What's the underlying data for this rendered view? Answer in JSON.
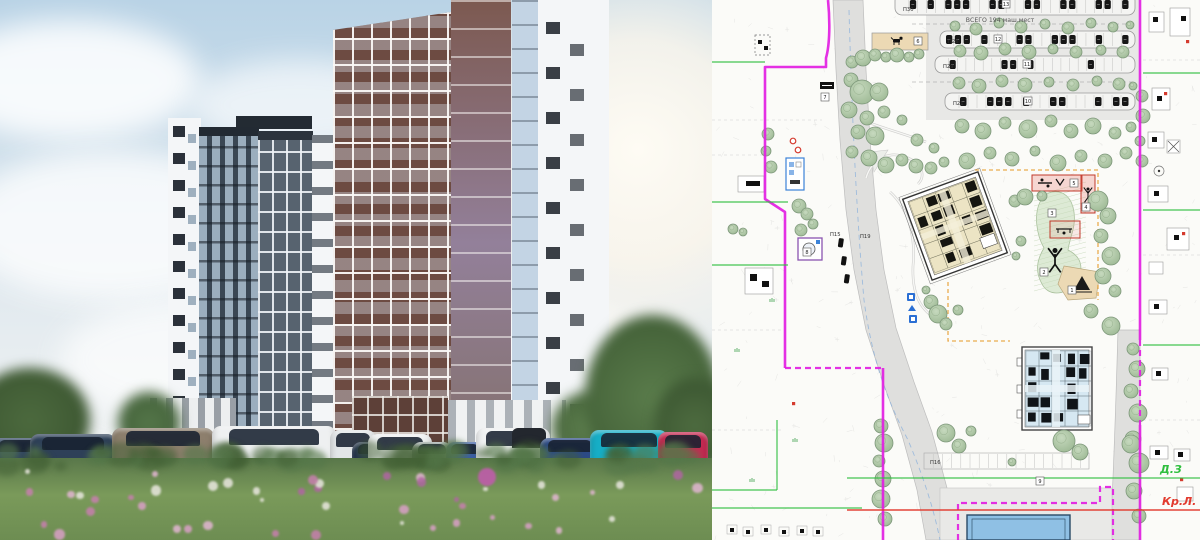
{
  "palette": {
    "sky1": "#b9d3e6",
    "sky2": "#e2eaef",
    "t_dark": "#3a4754",
    "t_mid": "#57636f",
    "t_white": "#f4f6f8",
    "t_brown": "#6d4b42",
    "t_brown2": "#7c5950",
    "meadow1": "#59774a",
    "meadow2": "#7a9a5a",
    "boundary": "#e21ee2",
    "green": "#2fbf3f",
    "red": "#e23a2e",
    "orange": "#e8a33d",
    "road": "#dfdfdd",
    "tree": "#b5cbad",
    "treeStroke": "#7d977a",
    "bld1": "#ece4c4",
    "bld2": "#d6e8f2",
    "bluebld": "#8fc0e4",
    "sand": "#ecd9b4"
  },
  "render": {
    "cars": [
      {
        "x": -8,
        "w": 52,
        "h": 34,
        "c": "#324664"
      },
      {
        "x": 30,
        "w": 86,
        "h": 38,
        "c": "#2e4058"
      },
      {
        "x": 112,
        "w": 102,
        "h": 44,
        "c": "#8d7f6d"
      },
      {
        "x": 212,
        "w": 124,
        "h": 46,
        "c": "#eef0f1"
      },
      {
        "x": 330,
        "w": 46,
        "h": 42,
        "c": "#e3e6e8"
      },
      {
        "x": 352,
        "w": 40,
        "h": 30,
        "c": "#253450"
      },
      {
        "x": 368,
        "w": 64,
        "h": 38,
        "c": "#eff1f2"
      },
      {
        "x": 412,
        "w": 40,
        "h": 30,
        "c": "#b6bcc2"
      },
      {
        "x": 446,
        "w": 38,
        "h": 30,
        "c": "#3a5da8"
      },
      {
        "x": 476,
        "w": 74,
        "h": 44,
        "c": "#f0f2f3",
        "canopy": "#23272e"
      },
      {
        "x": 540,
        "w": 60,
        "h": 34,
        "c": "#2c4a86"
      },
      {
        "x": 590,
        "w": 78,
        "h": 42,
        "c": "#17aec6"
      },
      {
        "x": 658,
        "w": 50,
        "h": 40,
        "c": "#c62a52"
      }
    ],
    "flowers": {
      "palette": [
        "#c77fae",
        "#b065a2",
        "#d9a0c6",
        "#e9e7df",
        "#e2b6d2"
      ],
      "count": 46,
      "highlight": {
        "x": 487,
        "y": 477,
        "r": 9,
        "color": "#bb5fa6"
      }
    }
  },
  "plan": {
    "labels": {
      "total": {
        "text": "ВСЕГО 194 маш.мест",
        "x": 288,
        "y": 22
      },
      "zones": [
        {
          "text": "Д.З",
          "x": 448,
          "y": 473,
          "color": "#2fbf3f"
        },
        {
          "text": "Кр.Л.",
          "x": 450,
          "y": 505,
          "color": "#e23a2e"
        }
      ],
      "rows": [
        {
          "text": "П30",
          "x": 191,
          "y": 11
        },
        {
          "text": "П26",
          "x": 236,
          "y": 43
        },
        {
          "text": "П29",
          "x": 231,
          "y": 68
        },
        {
          "text": "П21",
          "x": 241,
          "y": 105
        },
        {
          "text": "П15",
          "x": 118,
          "y": 236
        },
        {
          "text": "П19",
          "x": 148,
          "y": 238
        },
        {
          "text": "П16",
          "x": 218,
          "y": 464
        }
      ]
    },
    "chips": [
      [
        294,
        4,
        "13"
      ],
      [
        286,
        39,
        "12"
      ],
      [
        315,
        64,
        "11"
      ],
      [
        316,
        101,
        "10"
      ],
      [
        206,
        41,
        "6"
      ],
      [
        113,
        97,
        "7"
      ],
      [
        95,
        252,
        "8"
      ],
      [
        328,
        481,
        "9"
      ],
      [
        360,
        290,
        "1"
      ],
      [
        332,
        272,
        "2"
      ],
      [
        340,
        213,
        "3"
      ],
      [
        374,
        207,
        "4"
      ],
      [
        362,
        183,
        "5"
      ]
    ],
    "parking_rows": [
      {
        "x": 183,
        "y": -6,
        "w": 240,
        "h": 21,
        "slots": 26,
        "cars": [
          1,
          3,
          5,
          6,
          7,
          10,
          11,
          14,
          15,
          18,
          19,
          22,
          23,
          25
        ]
      },
      {
        "x": 228,
        "y": 31,
        "w": 195,
        "h": 17,
        "slots": 21,
        "cars": [
          0,
          1,
          2,
          4,
          8,
          9,
          12,
          13,
          14,
          17,
          20
        ]
      },
      {
        "x": 223,
        "y": 56,
        "w": 200,
        "h": 17,
        "slots": 22,
        "cars": [
          1,
          7,
          8,
          10,
          17
        ]
      },
      {
        "x": 233,
        "y": 93,
        "w": 190,
        "h": 17,
        "slots": 20,
        "cars": [
          1,
          4,
          5,
          6,
          8,
          11,
          12,
          16,
          18,
          19
        ]
      }
    ],
    "boundary": {
      "solid": [
        "M116,0 C118,20 118,44 114,58 L114,67 L53,67 L53,199 L73,212 L73,368",
        "M171,368 L171,540",
        "M428,0 L428,340",
        "M428,425 L428,540"
      ],
      "dashed": [
        "M73,368 L171,368",
        "M428,340 L428,425",
        "M246,540 L246,503 L388,503 L388,487 L401,487 L401,540"
      ]
    },
    "green_lines": [
      [
        0,
        62,
        53,
        62
      ],
      [
        0,
        202,
        76,
        202
      ],
      [
        0,
        265,
        76,
        265
      ],
      [
        65,
        420,
        65,
        490
      ],
      [
        0,
        490,
        65,
        490
      ],
      [
        0,
        508,
        150,
        508
      ],
      [
        135,
        478,
        488,
        478
      ],
      [
        431,
        73,
        488,
        73
      ],
      [
        431,
        210,
        488,
        210
      ],
      [
        431,
        345,
        488,
        345
      ]
    ],
    "red_lines": [
      [
        135,
        510,
        488,
        510
      ]
    ],
    "orange_dashed": [
      "M263,170 L386,170 L386,300",
      "M236,282 L236,341 L298,341"
    ],
    "parcel_dashed": [
      [
        0,
        120,
        110,
        120
      ],
      [
        0,
        155,
        60,
        155
      ],
      [
        0,
        330,
        70,
        330
      ],
      [
        0,
        430,
        70,
        430
      ],
      [
        431,
        60,
        488,
        60
      ],
      [
        431,
        255,
        488,
        255
      ],
      [
        431,
        420,
        488,
        420
      ]
    ],
    "trees": [
      [
        140,
        62,
        6
      ],
      [
        151,
        58,
        8
      ],
      [
        163,
        55,
        6
      ],
      [
        174,
        57,
        5
      ],
      [
        185,
        55,
        7
      ],
      [
        197,
        57,
        5
      ],
      [
        207,
        54,
        5
      ],
      [
        139,
        80,
        7
      ],
      [
        150,
        92,
        12
      ],
      [
        167,
        92,
        9
      ],
      [
        137,
        110,
        8
      ],
      [
        155,
        118,
        7
      ],
      [
        172,
        112,
        6
      ],
      [
        146,
        132,
        7
      ],
      [
        163,
        136,
        9
      ],
      [
        140,
        152,
        6
      ],
      [
        157,
        158,
        8
      ],
      [
        174,
        165,
        8
      ],
      [
        190,
        160,
        6
      ],
      [
        204,
        166,
        7
      ],
      [
        219,
        168,
        6
      ],
      [
        232,
        162,
        5
      ],
      [
        190,
        120,
        5
      ],
      [
        205,
        140,
        6
      ],
      [
        222,
        148,
        5
      ],
      [
        243,
        26,
        5
      ],
      [
        264,
        29,
        6
      ],
      [
        287,
        23,
        5
      ],
      [
        309,
        27,
        6
      ],
      [
        333,
        24,
        5
      ],
      [
        356,
        28,
        6
      ],
      [
        379,
        23,
        5
      ],
      [
        401,
        27,
        5
      ],
      [
        418,
        25,
        4
      ],
      [
        248,
        51,
        6
      ],
      [
        269,
        53,
        7
      ],
      [
        293,
        49,
        6
      ],
      [
        317,
        52,
        7
      ],
      [
        341,
        49,
        5
      ],
      [
        364,
        52,
        6
      ],
      [
        389,
        50,
        5
      ],
      [
        411,
        52,
        6
      ],
      [
        247,
        83,
        6
      ],
      [
        267,
        86,
        7
      ],
      [
        290,
        81,
        6
      ],
      [
        313,
        85,
        7
      ],
      [
        337,
        82,
        5
      ],
      [
        361,
        85,
        6
      ],
      [
        385,
        81,
        5
      ],
      [
        407,
        84,
        6
      ],
      [
        421,
        86,
        4
      ],
      [
        250,
        126,
        7
      ],
      [
        271,
        131,
        8
      ],
      [
        293,
        123,
        6
      ],
      [
        316,
        129,
        9
      ],
      [
        339,
        121,
        6
      ],
      [
        359,
        131,
        7
      ],
      [
        381,
        126,
        8
      ],
      [
        403,
        133,
        6
      ],
      [
        419,
        127,
        5
      ],
      [
        255,
        161,
        8
      ],
      [
        278,
        153,
        6
      ],
      [
        300,
        159,
        7
      ],
      [
        323,
        151,
        5
      ],
      [
        346,
        163,
        8
      ],
      [
        369,
        156,
        6
      ],
      [
        393,
        161,
        7
      ],
      [
        414,
        153,
        6
      ],
      [
        56,
        134,
        6
      ],
      [
        54,
        151,
        5
      ],
      [
        59,
        167,
        6
      ],
      [
        87,
        206,
        7
      ],
      [
        95,
        214,
        6
      ],
      [
        101,
        224,
        5
      ],
      [
        89,
        230,
        6
      ],
      [
        21,
        229,
        5
      ],
      [
        31,
        232,
        4
      ],
      [
        219,
        302,
        7
      ],
      [
        226,
        314,
        9
      ],
      [
        234,
        324,
        6
      ],
      [
        246,
        310,
        5
      ],
      [
        214,
        290,
        4
      ],
      [
        303,
        201,
        6
      ],
      [
        313,
        197,
        8
      ],
      [
        386,
        201,
        10
      ],
      [
        396,
        216,
        8
      ],
      [
        389,
        236,
        7
      ],
      [
        399,
        256,
        9
      ],
      [
        391,
        276,
        8
      ],
      [
        403,
        291,
        6
      ],
      [
        379,
        311,
        7
      ],
      [
        399,
        326,
        9
      ],
      [
        309,
        241,
        5
      ],
      [
        304,
        256,
        4
      ],
      [
        330,
        196,
        5
      ],
      [
        421,
        349,
        6
      ],
      [
        425,
        369,
        8
      ],
      [
        419,
        391,
        7
      ],
      [
        426,
        413,
        9
      ],
      [
        421,
        439,
        8
      ],
      [
        427,
        463,
        10
      ],
      [
        422,
        491,
        8
      ],
      [
        427,
        516,
        7
      ],
      [
        430,
        96,
        6
      ],
      [
        431,
        116,
        7
      ],
      [
        428,
        141,
        5
      ],
      [
        430,
        161,
        6
      ],
      [
        234,
        433,
        9
      ],
      [
        247,
        446,
        7
      ],
      [
        259,
        431,
        5
      ],
      [
        352,
        441,
        11
      ],
      [
        368,
        452,
        8
      ],
      [
        419,
        444,
        9
      ],
      [
        300,
        462,
        4
      ],
      [
        169,
        426,
        7
      ],
      [
        172,
        443,
        9
      ],
      [
        167,
        461,
        6
      ],
      [
        171,
        479,
        8
      ],
      [
        169,
        499,
        9
      ],
      [
        173,
        519,
        7
      ]
    ],
    "houses_right": [
      {
        "x": 437,
        "y": 12,
        "w": 15,
        "h": 20,
        "sq": [
          4,
          5
        ]
      },
      {
        "x": 458,
        "y": 8,
        "w": 20,
        "h": 28,
        "sq": [
          11,
          8
        ]
      },
      {
        "x": 440,
        "y": 88,
        "w": 18,
        "h": 22,
        "sq": [
          5,
          8
        ]
      },
      {
        "x": 436,
        "y": 132,
        "w": 16,
        "h": 16,
        "sq": [
          4,
          5
        ]
      },
      {
        "x": 455,
        "y": 140,
        "w": 13,
        "h": 13,
        "xmark": true
      },
      {
        "x": 436,
        "y": 186,
        "w": 20,
        "h": 16,
        "sq": [
          6,
          5
        ]
      },
      {
        "x": 455,
        "y": 228,
        "w": 22,
        "h": 22,
        "sq": [
          7,
          7
        ]
      },
      {
        "x": 437,
        "y": 262,
        "w": 14,
        "h": 12
      },
      {
        "x": 437,
        "y": 300,
        "w": 18,
        "h": 14,
        "sq": [
          5,
          4
        ]
      },
      {
        "x": 440,
        "y": 368,
        "w": 16,
        "h": 12,
        "sq": [
          4,
          3
        ]
      },
      {
        "x": 438,
        "y": 446,
        "w": 18,
        "h": 13,
        "sq": [
          5,
          4
        ]
      },
      {
        "x": 462,
        "y": 449,
        "w": 16,
        "h": 12,
        "sq": [
          4,
          3
        ]
      },
      {
        "x": 465,
        "y": 487,
        "w": 16,
        "h": 14
      }
    ],
    "red_ticks": [
      [
        80,
        402
      ],
      [
        474,
        40
      ],
      [
        452,
        92
      ],
      [
        470,
        232
      ],
      [
        468,
        478
      ]
    ],
    "green_ticks": [
      [
        83,
        440
      ],
      [
        60,
        300
      ],
      [
        40,
        480
      ],
      [
        25,
        350
      ]
    ]
  }
}
